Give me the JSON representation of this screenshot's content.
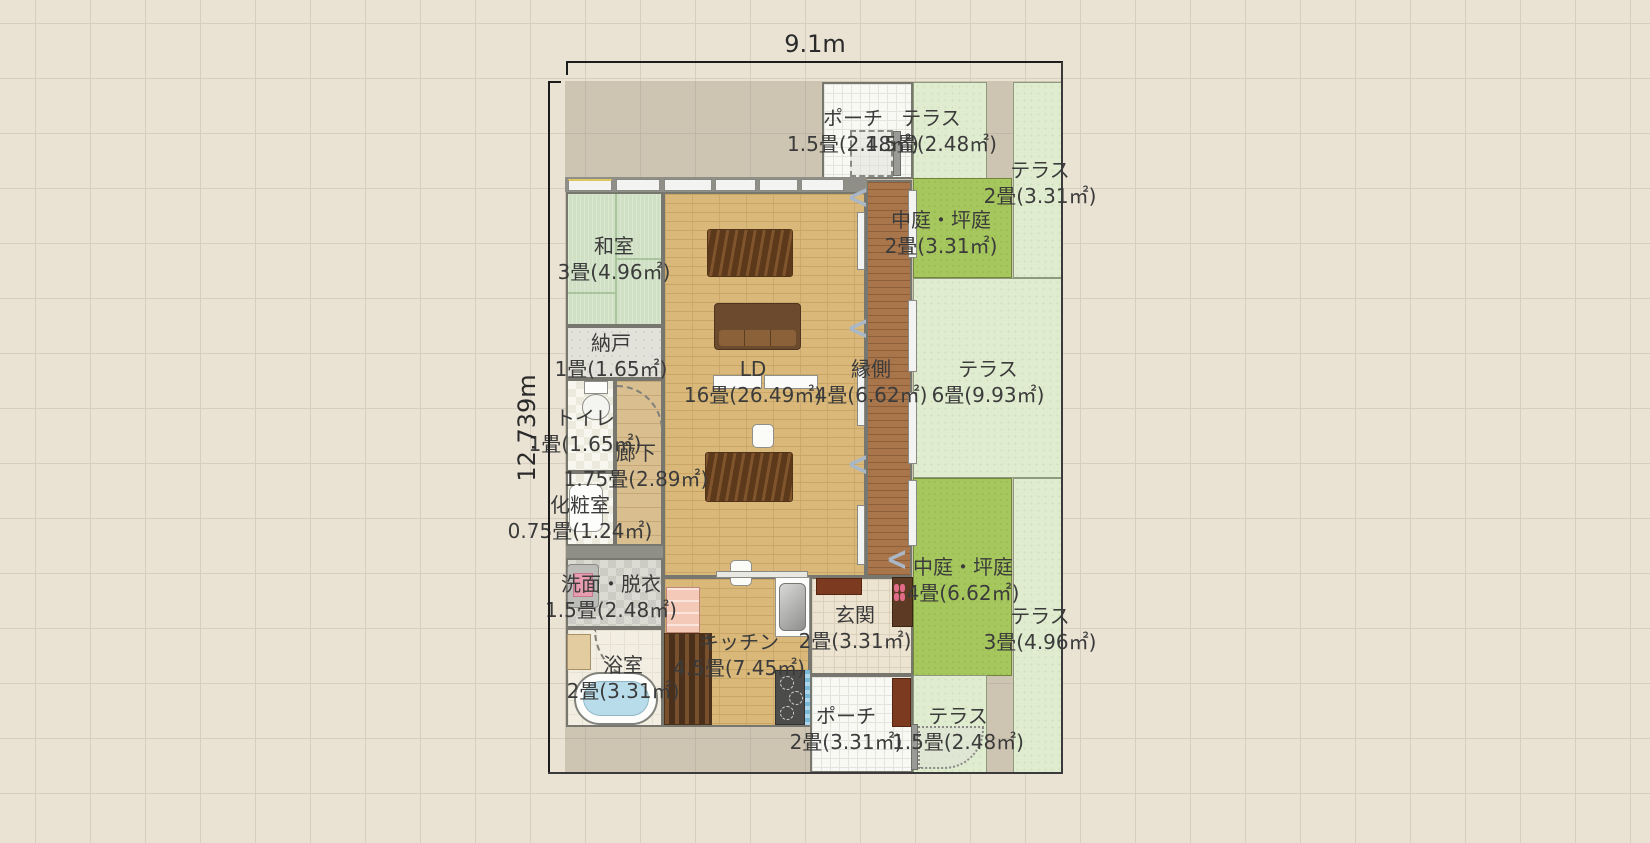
{
  "dimensions": {
    "width_label": "9.1m",
    "height_label": "12.739m"
  },
  "rooms": {
    "washitsu": {
      "name": "和室",
      "size": "3畳(4.96㎡)"
    },
    "nando": {
      "name": "納戸",
      "size": "1畳(1.65㎡)"
    },
    "toilet": {
      "name": "トイレ",
      "size": "1畳(1.65㎡)"
    },
    "rouka": {
      "name": "廊下",
      "size": "1.75畳(2.89㎡)"
    },
    "keshoushitsu": {
      "name": "化粧室",
      "size": "0.75畳(1.24㎡)"
    },
    "senmen": {
      "name": "洗面・脱衣",
      "size": "1.5畳(2.48㎡)"
    },
    "yokushitsu": {
      "name": "浴室",
      "size": "2畳(3.31㎡)"
    },
    "kitchen": {
      "name": "キッチン",
      "size": "4.5畳(7.45㎡)"
    },
    "ld": {
      "name": "LD",
      "size": "16畳(26.49㎡)"
    },
    "engawa": {
      "name": "縁側",
      "size": "4畳(6.62㎡)"
    },
    "terrace6": {
      "name": "テラス",
      "size": "6畳(9.93㎡)"
    },
    "nakaniwa2": {
      "name": "中庭・坪庭",
      "size": "2畳(3.31㎡)"
    },
    "terrace2": {
      "name": "テラス",
      "size": "2畳(3.31㎡)"
    },
    "porch_top": {
      "name": "ポーチ",
      "size": "1.5畳(2.48㎡)"
    },
    "terrace15_top": {
      "name": "テラス",
      "size": "1.5畳(2.48㎡)"
    },
    "genkan": {
      "name": "玄関",
      "size": "2畳(3.31㎡)"
    },
    "nakaniwa4": {
      "name": "中庭・坪庭",
      "size": "4畳(6.62㎡)"
    },
    "terrace3": {
      "name": "テラス",
      "size": "3畳(4.96㎡)"
    },
    "porch_bottom": {
      "name": "ポーチ",
      "size": "2畳(3.31㎡)"
    },
    "terrace15_bottom": {
      "name": "テラス",
      "size": "1.5畳(2.48㎡)"
    }
  },
  "icons": {
    "slide_chevron": "<"
  },
  "palette": {
    "courtyard_green": "#a6c75e",
    "terrace_green": "#e0ecd0",
    "tatami_green": "#cfe0c4",
    "flooring_wood": "#d9b87a",
    "engawa_wood": "#a9764c",
    "site_gray": "#cdc3b3"
  }
}
